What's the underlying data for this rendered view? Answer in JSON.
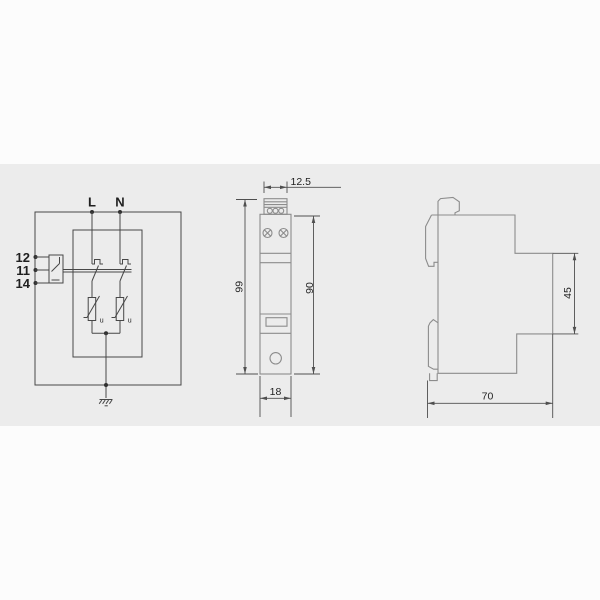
{
  "drawing": {
    "type": "surge-protective-device dimensional drawing",
    "views": [
      "wiring-diagram",
      "front-view",
      "side-view"
    ]
  },
  "colors": {
    "page_background": "#fcfcfc",
    "band_background": "#ececec",
    "circuit_line": "#474747",
    "outline_line": "#8c8c8c",
    "dimension_line": "#4f4f4f",
    "text": "#1f1f1f"
  },
  "circuit": {
    "phase_label": "L",
    "neutral_label": "N",
    "terminals": {
      "nc": "12",
      "com": "11",
      "no": "14"
    },
    "varistor_left_label": "u",
    "varistor_right_label": "u"
  },
  "front_view": {
    "dim_top_width": "12.5",
    "dim_total_height": "99",
    "dim_body_height": "90",
    "dim_bottom_width": "18"
  },
  "side_view": {
    "dim_upper_depth": "45",
    "dim_total_depth": "70"
  }
}
